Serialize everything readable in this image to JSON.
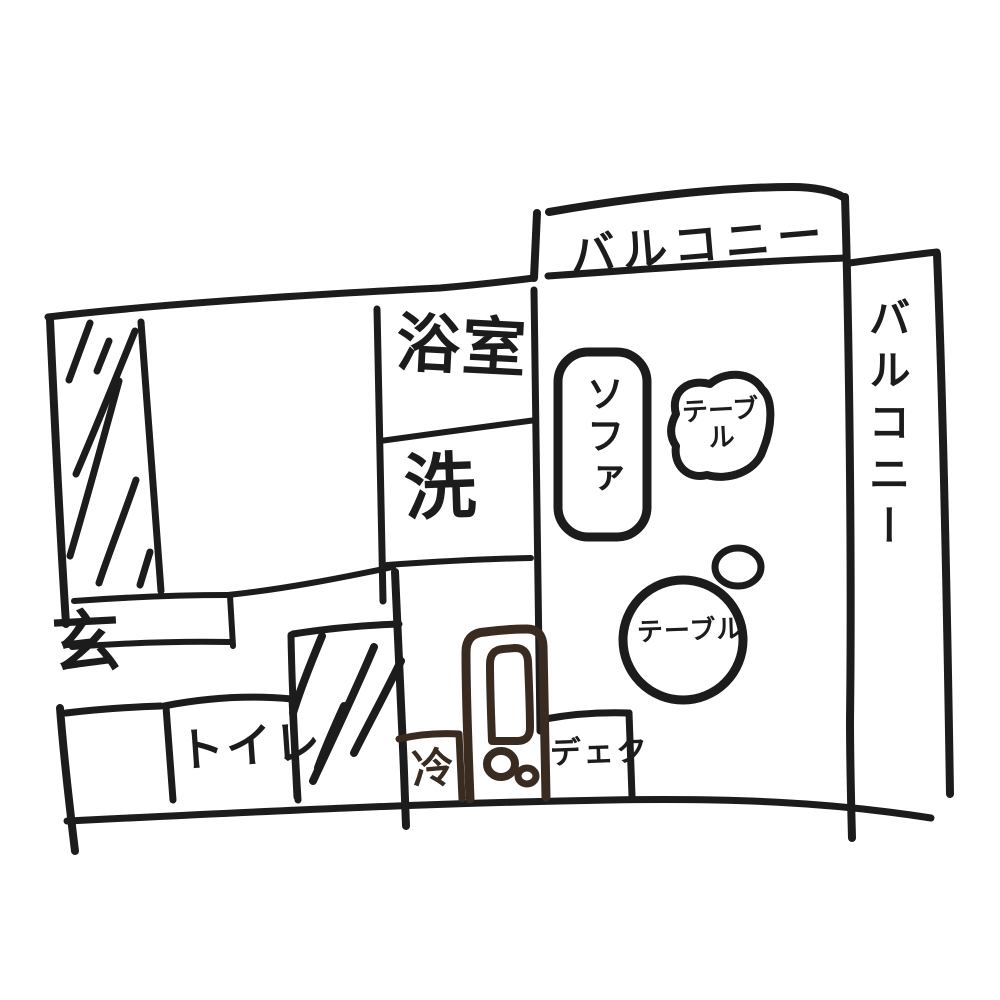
{
  "title": "手書き間取り図 (hand-drawn apartment floor plan)",
  "colors": {
    "background": "#ffffff",
    "ink": "#1c1c1c",
    "fridge_ink": "#3a2b20"
  },
  "rooms": {
    "balcony_top": {
      "label": "バルコニー"
    },
    "balcony_right": {
      "label": "バルコニー"
    },
    "bathroom": {
      "label": "浴室"
    },
    "laundry": {
      "label": "洗"
    },
    "entrance": {
      "label": "玄"
    },
    "toilet": {
      "label": "トイレ"
    }
  },
  "furniture": {
    "sofa": {
      "label": "ソファ"
    },
    "table_blob": {
      "label": "テーブル"
    },
    "table_round": {
      "label": "テーブル"
    },
    "refrigerator": {
      "label": "冷"
    },
    "desk": {
      "label": "デェク"
    }
  }
}
